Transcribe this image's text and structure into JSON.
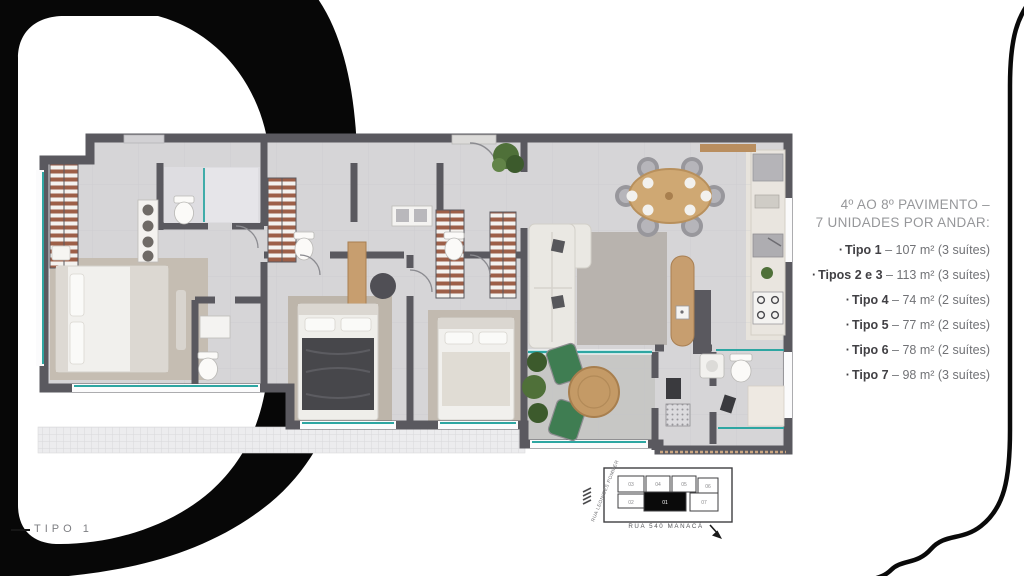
{
  "legend": {
    "header_line1": "4º AO 8º PAVIMENTO –",
    "header_line2": "7 UNIDADES POR ANDAR:",
    "items": [
      {
        "bullet": "·",
        "name": "Tipo 1",
        "detail": "– 107 m² (3 suítes)"
      },
      {
        "bullet": "·",
        "name": "Tipos 2 e 3",
        "detail": "– 113 m² (3 suítes)"
      },
      {
        "bullet": "·",
        "name": "Tipo 4",
        "detail": "– 74 m² (2 suítes)"
      },
      {
        "bullet": "·",
        "name": "Tipo 5",
        "detail": "– 77 m² (2 suítes)"
      },
      {
        "bullet": "·",
        "name": "Tipo 6",
        "detail": "– 78 m² (2 suítes)"
      },
      {
        "bullet": "·",
        "name": "Tipo 7",
        "detail": "– 98 m² (3 suítes)"
      }
    ]
  },
  "plan_label": {
    "text": "TIPO 1"
  },
  "keyplan": {
    "street_left": "RUA LEONIDES POMMER",
    "street_bottom": "RUA 540 MANACÁ",
    "units": {
      "u01": "01",
      "u02": "02",
      "u03": "03",
      "u04": "04",
      "u05": "05",
      "u06": "06",
      "u07": "07"
    }
  },
  "colors": {
    "ink": "#0a0a0a",
    "wall": "#5a595f",
    "floor": "#d6d5d7",
    "glass_teal": "#2ea6a2",
    "wood": "#c79e6f",
    "wardrobe_rust": "#9d5f48",
    "terrace_green": "#3f7d52"
  }
}
